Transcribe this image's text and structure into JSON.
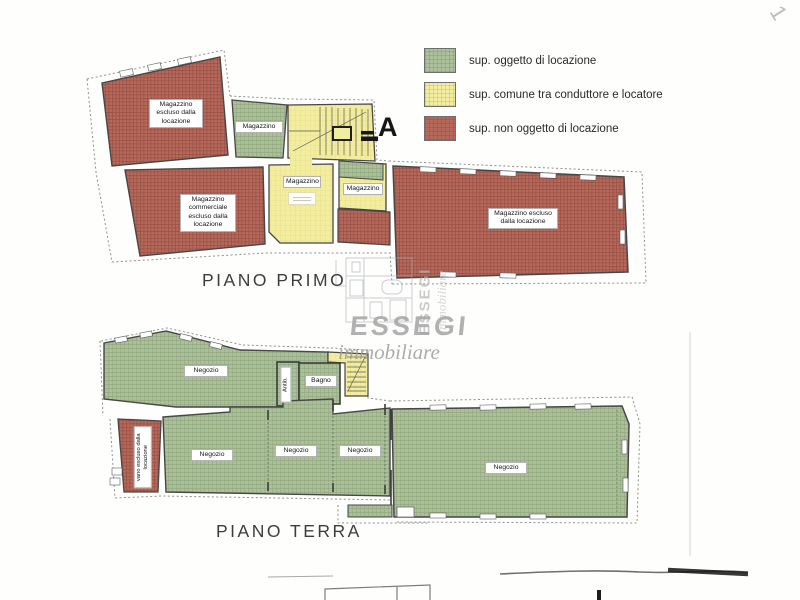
{
  "page": {
    "corner_mark": "1"
  },
  "legend": {
    "items": [
      {
        "label": "sup. oggetto di locazione",
        "color": "#abbf9b"
      },
      {
        "label": "sup. comune tra conduttore e locatore",
        "color": "#f2ed9f"
      },
      {
        "label": "sup. non oggetto di locazione",
        "color": "#b5695b"
      }
    ]
  },
  "watermark": {
    "brand": "ESSEGI",
    "tagline": "immobiliare"
  },
  "first_floor": {
    "title": "PIANO PRIMO",
    "section_marker": "A",
    "rooms": {
      "storage_excluded_nw": "Magazzino escluso dalla locazione",
      "storage_green": "Magazzino",
      "storage_common_main": "Magazzino",
      "storage_common_right": "Magazzino",
      "storage_commercial_excluded": "Magazzino commerciale escluso dalla locazione",
      "storage_excluded_east": "Magazzino escluso dalla locazione"
    }
  },
  "ground_floor": {
    "title": "PIANO TERRA",
    "rooms": {
      "shop_top": "Negozio",
      "anteroom": "Antib.",
      "bathroom": "Bagno",
      "shaft_excluded": "vano escluso dalla locazione",
      "shop_left": "Negozio",
      "shop_center": "Negozio",
      "shop_right": "Negozio",
      "shop_east": "Negozio"
    }
  }
}
